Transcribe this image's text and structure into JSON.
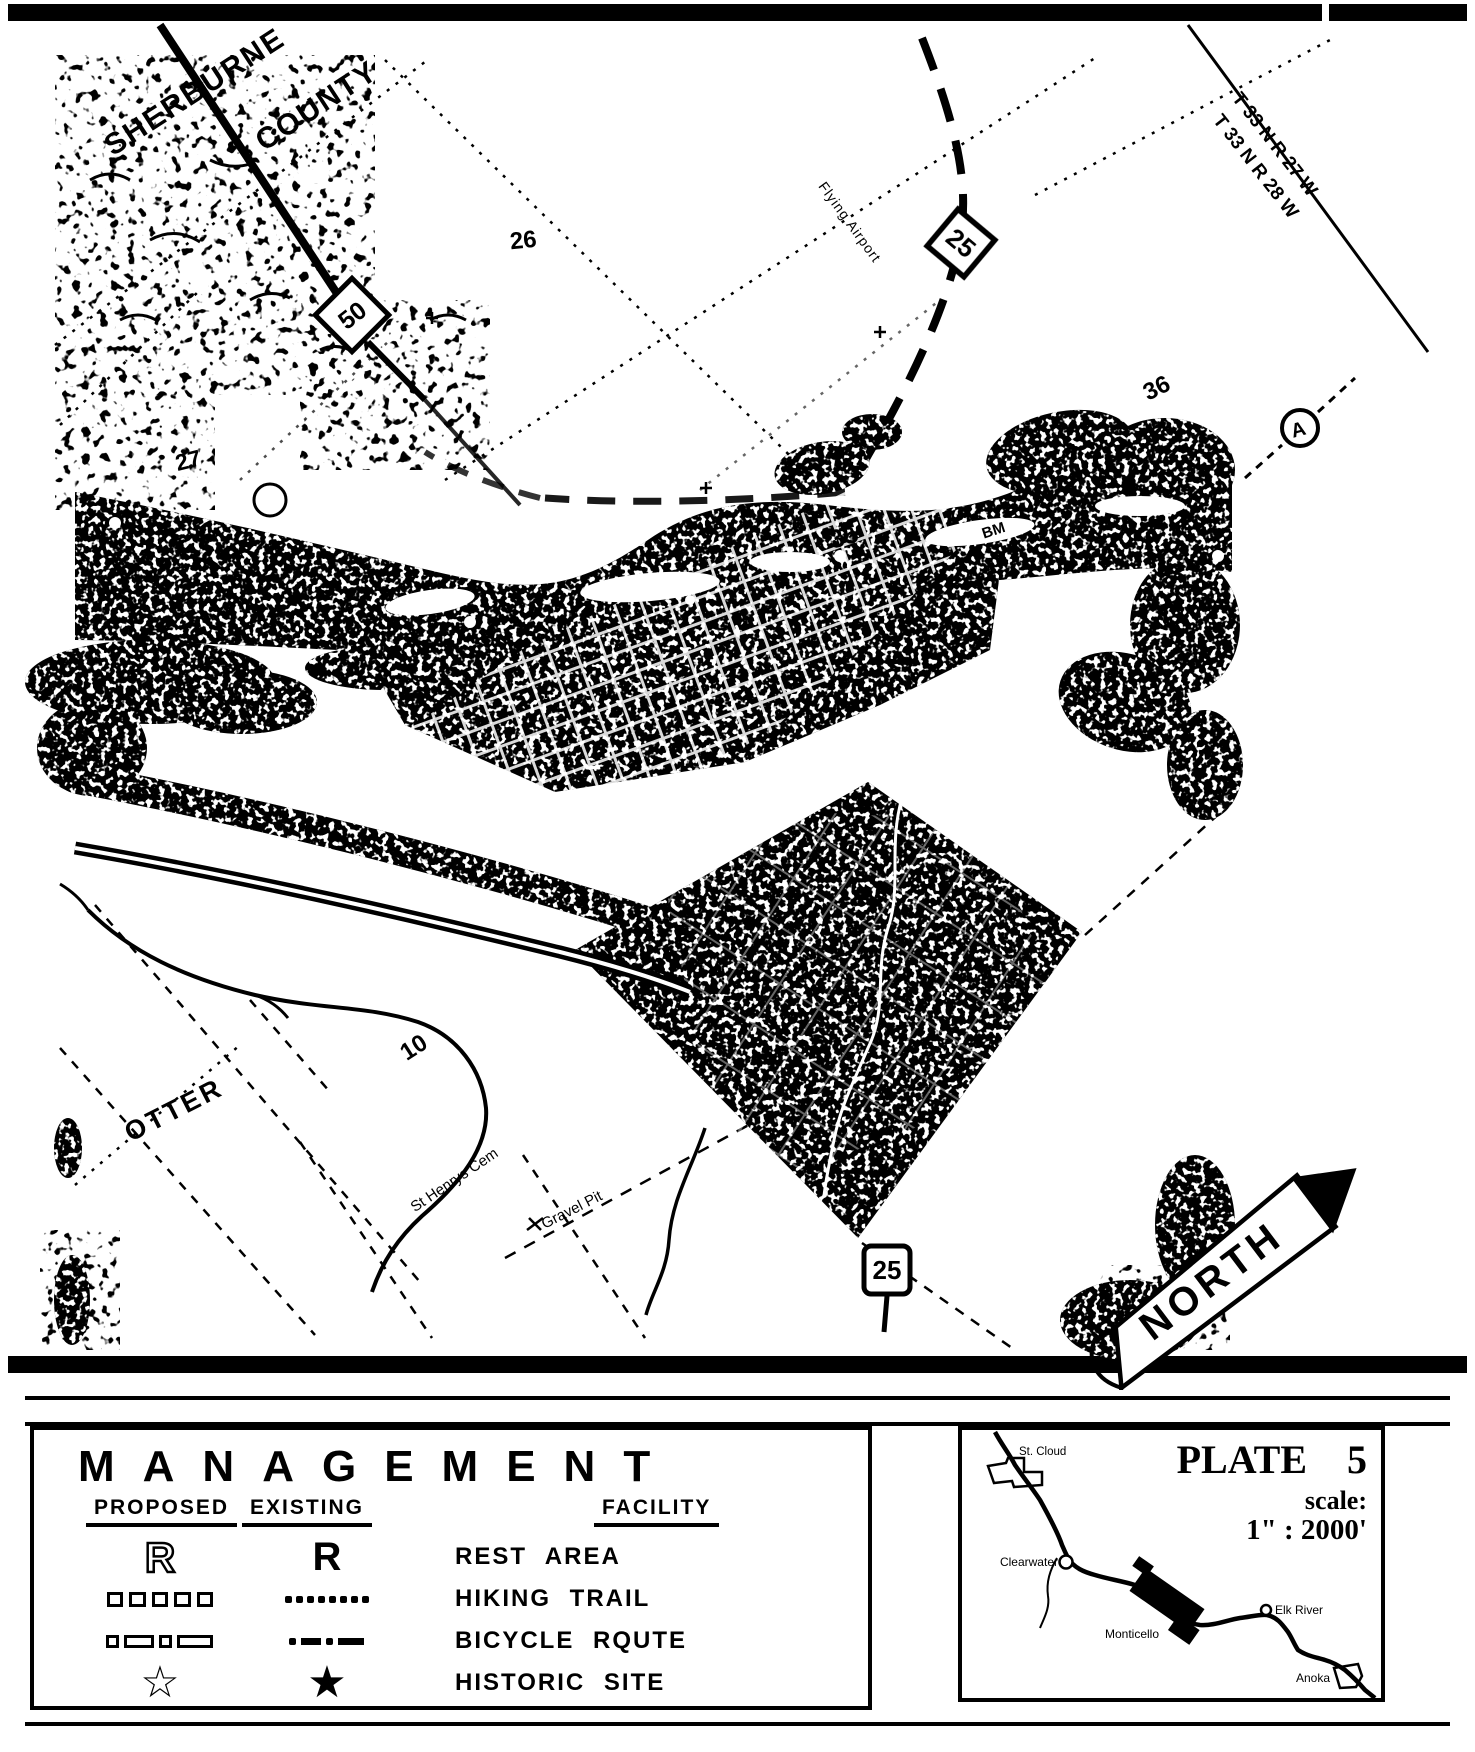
{
  "map": {
    "county_word1": "SHERBURNE",
    "county_word2": "COUNTY",
    "township_row1": "T 33 N R 27 W",
    "township_row2": "T 33 N R 28 W",
    "sections": {
      "s26": "26",
      "s27": "27",
      "s35": "35",
      "s36": "36",
      "s10": "10"
    },
    "shields": {
      "hw50": "50",
      "hw25_top": "25",
      "hw25_bottom": "25"
    },
    "labels": {
      "bm": "BM",
      "airport": "Flying Airport",
      "airport_marker": "A",
      "otter": "OTTER",
      "cemetery": "St Henrys Cem",
      "gravel_pit": "Gravel Pit"
    },
    "north": "NORTH"
  },
  "legend": {
    "title": "MANAGEMENT",
    "col_proposed": "PROPOSED",
    "col_existing": "EXISTING",
    "col_facility": "FACILITY",
    "rest_symbol": "R",
    "star_open": "☆",
    "star_solid": "★",
    "rows": [
      {
        "facility": "REST AREA"
      },
      {
        "facility": "HIKING TRAIL"
      },
      {
        "facility": "BICYCLE RQUTE"
      },
      {
        "facility": "HISTORIC SITE"
      }
    ]
  },
  "inset": {
    "plate_title": "PLATE 5",
    "scale_label": "scale:",
    "scale_value": "1\" : 2000'",
    "cities": {
      "st_cloud": "St. Cloud",
      "clearwater": "Clearwater",
      "monticello": "Monticello",
      "elk_river": "Elk River",
      "anoka": "Anoka"
    }
  }
}
